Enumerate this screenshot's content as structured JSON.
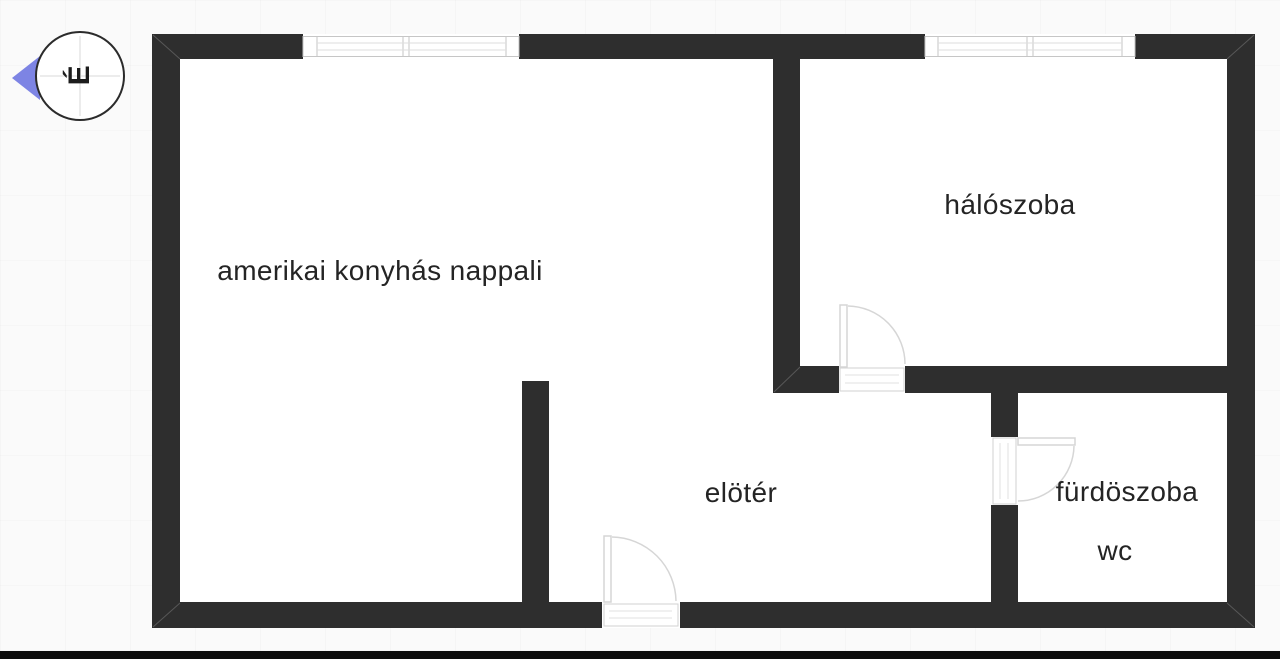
{
  "compass": {
    "letter": "É",
    "arrow_color": "#7d84e4"
  },
  "colors": {
    "wall": "#2e2e2e",
    "floor": "#ffffff",
    "background": "#fafafa",
    "label_text": "#242424",
    "window_outline": "#c6c6c6",
    "window_glazing": "#dedede",
    "door_arc": "#d6d6d6",
    "bottom_bar": "#0c0c0c"
  },
  "rooms": [
    {
      "id": "living",
      "label": "amerikai konyhás nappali"
    },
    {
      "id": "bedroom",
      "label": "hálószoba"
    },
    {
      "id": "hall",
      "label": "elötér"
    },
    {
      "id": "bathroom",
      "label": "fürdöszoba"
    },
    {
      "id": "wc",
      "label": "wc"
    }
  ]
}
